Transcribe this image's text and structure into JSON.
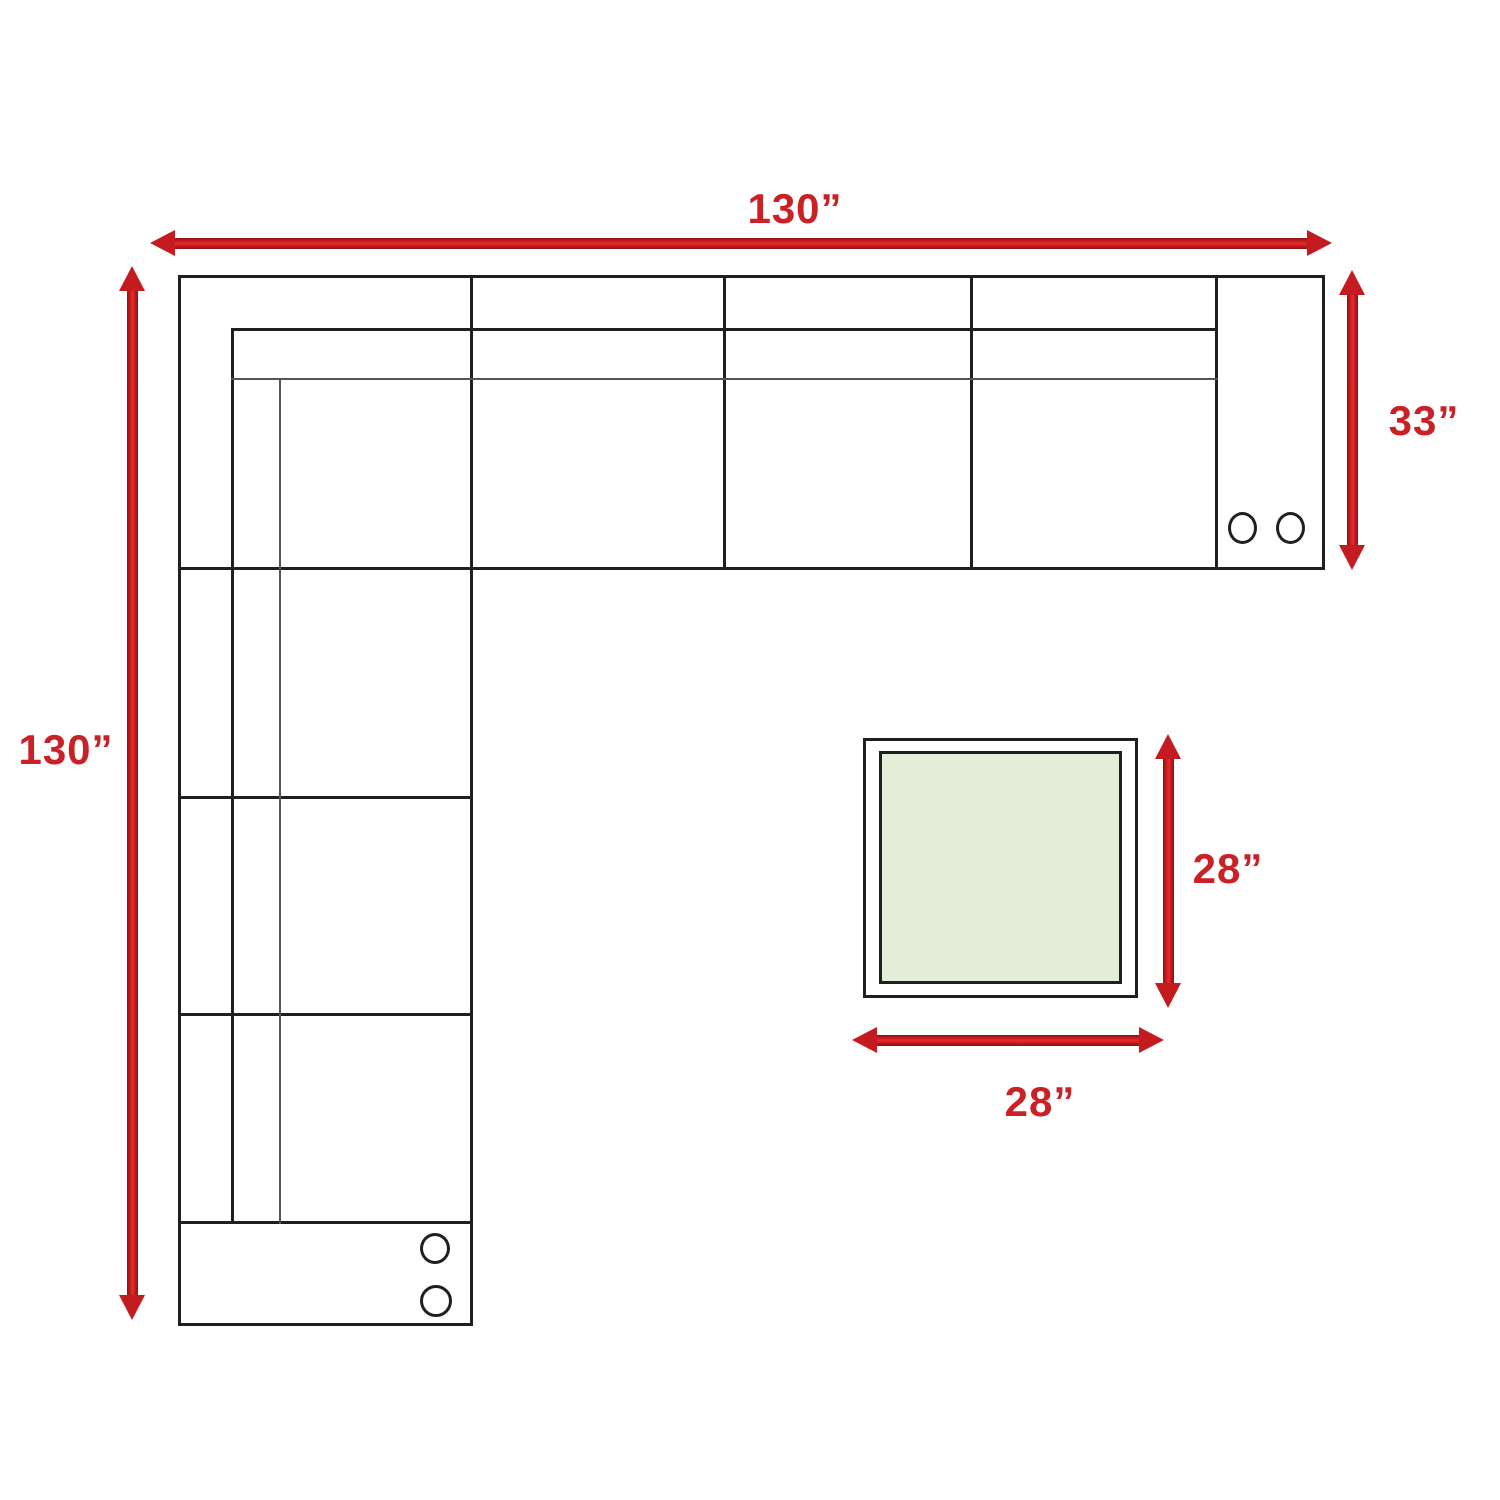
{
  "diagram_title": "Sectional sofa and table floor-plan with dimensions",
  "sofa": {
    "width_label": "130”",
    "width_value_in": 130,
    "height_label": "130”",
    "height_value_in": 130,
    "depth_label": "33”",
    "depth_value_in": 33,
    "top_band_seat_count": 3,
    "left_column_seat_count": 3,
    "arm_cupholder_count": 4
  },
  "table": {
    "width_label": "28”",
    "width_value_in": 28,
    "height_label": "28”",
    "height_value_in": 28,
    "top_fill": "#e2eed9"
  },
  "colors": {
    "dimension_red_text": "#ca2127",
    "arrow_red_bright": "#ea2b28",
    "arrow_red_dark": "#8a1316",
    "arrow_head_red": "#c41b20",
    "outline_black": "#1f1f1f",
    "outline_gray": "#555555",
    "background": "#ffffff"
  }
}
